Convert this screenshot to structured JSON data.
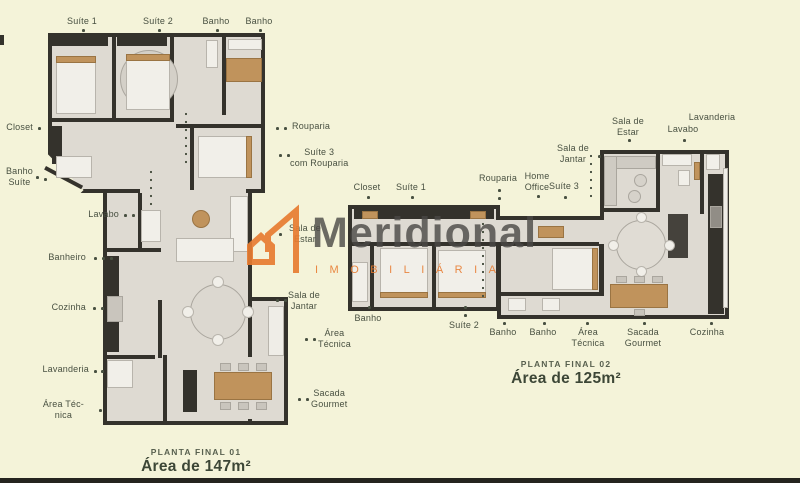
{
  "colors": {
    "bg": "#f4f3d9",
    "wall": "#34322c",
    "floor": "#dedad2",
    "wood": "#c0935c",
    "white": "#f1efe9",
    "gray": "#c9c5bd",
    "label": "#485041",
    "caption": "#3c4636",
    "accent": "#e87c31",
    "brand": "#4a4845"
  },
  "watermark": {
    "brand": "Meridional",
    "tagline": "IMOBILIÁRIA",
    "logo": "meridional-m-logo"
  },
  "plans": [
    {
      "id": "planta-final-01",
      "caption_title": "PLANTA FINAL 01",
      "caption_area": "Área de 147m²",
      "caption_x": 196,
      "caption_y": 447,
      "labels": [
        {
          "t": "Suíte 1",
          "x": 82,
          "y": 16,
          "a": "c"
        },
        {
          "t": "Suíte 2",
          "x": 158,
          "y": 16,
          "a": "c"
        },
        {
          "t": "Banho",
          "x": 216,
          "y": 16,
          "a": "c"
        },
        {
          "t": "Banho",
          "x": 259,
          "y": 16,
          "a": "c"
        },
        {
          "t": "Closet",
          "x": 33,
          "y": 122,
          "a": "r"
        },
        {
          "t": "Banho\nSuíte",
          "x": 33,
          "y": 166,
          "a": "r"
        },
        {
          "t": "Lavabo",
          "x": 119,
          "y": 209,
          "a": "r"
        },
        {
          "t": "Banheiro",
          "x": 86,
          "y": 252,
          "a": "r"
        },
        {
          "t": "Cozinha",
          "x": 86,
          "y": 302,
          "a": "r"
        },
        {
          "t": "Lavanderia",
          "x": 89,
          "y": 364,
          "a": "r"
        },
        {
          "t": "Área Téc-\nnica",
          "x": 84,
          "y": 399,
          "a": "r"
        },
        {
          "t": "Rouparia",
          "x": 292,
          "y": 121,
          "a": "l"
        },
        {
          "t": "Suíte 3\ncom Rouparia",
          "x": 290,
          "y": 147,
          "a": "l"
        },
        {
          "t": "Sala de\nEstar",
          "x": 289,
          "y": 223,
          "a": "l"
        },
        {
          "t": "Sala de\nJantar",
          "x": 288,
          "y": 290,
          "a": "l"
        },
        {
          "t": "Área\nTécnica",
          "x": 318,
          "y": 328,
          "a": "l"
        },
        {
          "t": "Sacada\nGourmet",
          "x": 311,
          "y": 388,
          "a": "l"
        }
      ],
      "dots": [
        [
          82,
          29
        ],
        [
          158,
          29
        ],
        [
          216,
          29
        ],
        [
          259,
          29
        ],
        [
          38,
          127
        ],
        [
          36,
          176
        ],
        [
          44,
          178
        ],
        [
          124,
          214
        ],
        [
          132,
          214
        ],
        [
          94,
          257
        ],
        [
          102,
          257
        ],
        [
          110,
          257
        ],
        [
          93,
          307
        ],
        [
          101,
          307
        ],
        [
          94,
          370
        ],
        [
          101,
          370
        ],
        [
          99,
          409
        ],
        [
          276,
          127
        ],
        [
          284,
          127
        ],
        [
          279,
          154
        ],
        [
          287,
          154
        ],
        [
          279,
          233
        ],
        [
          276,
          299
        ],
        [
          284,
          299
        ],
        [
          305,
          338
        ],
        [
          313,
          338
        ],
        [
          298,
          398
        ],
        [
          306,
          398
        ]
      ],
      "chains": [
        {
          "x": 185,
          "y": 110,
          "h": 54
        },
        {
          "x": 150,
          "y": 168,
          "h": 40
        }
      ]
    },
    {
      "id": "planta-final-02",
      "caption_title": "PLANTA FINAL 02",
      "caption_area": "Área de 125m²",
      "caption_x": 566,
      "caption_y": 359,
      "labels": [
        {
          "t": "Closet",
          "x": 367,
          "y": 182,
          "a": "c"
        },
        {
          "t": "Suíte 1",
          "x": 411,
          "y": 182,
          "a": "c"
        },
        {
          "t": "Rouparia",
          "x": 498,
          "y": 173,
          "a": "c"
        },
        {
          "t": "Home\nOffice",
          "x": 537,
          "y": 171,
          "a": "c"
        },
        {
          "t": "Suíte 3",
          "x": 564,
          "y": 181,
          "a": "c"
        },
        {
          "t": "Sala de\nJantar",
          "x": 573,
          "y": 143,
          "a": "c"
        },
        {
          "t": "Sala de\nEstar",
          "x": 628,
          "y": 116,
          "a": "c"
        },
        {
          "t": "Lavabo",
          "x": 683,
          "y": 124,
          "a": "c"
        },
        {
          "t": "Lavanderia",
          "x": 712,
          "y": 112,
          "a": "c"
        },
        {
          "t": "Banho",
          "x": 368,
          "y": 313,
          "a": "c"
        },
        {
          "t": "Suíte 2",
          "x": 464,
          "y": 320,
          "a": "c"
        },
        {
          "t": "Banho",
          "x": 503,
          "y": 327,
          "a": "c"
        },
        {
          "t": "Banho",
          "x": 543,
          "y": 327,
          "a": "c"
        },
        {
          "t": "Área\nTécnica",
          "x": 588,
          "y": 327,
          "a": "c"
        },
        {
          "t": "Sacada\nGourmet",
          "x": 643,
          "y": 327,
          "a": "c"
        },
        {
          "t": "Cozinha",
          "x": 707,
          "y": 327,
          "a": "c"
        }
      ],
      "dots": [
        [
          367,
          196
        ],
        [
          411,
          196
        ],
        [
          498,
          189
        ],
        [
          498,
          197
        ],
        [
          537,
          195
        ],
        [
          564,
          196
        ],
        [
          598,
          155
        ],
        [
          628,
          139
        ],
        [
          683,
          139
        ],
        [
          368,
          306
        ],
        [
          464,
          306
        ],
        [
          464,
          314
        ],
        [
          503,
          322
        ],
        [
          543,
          322
        ],
        [
          586,
          322
        ],
        [
          643,
          322
        ],
        [
          710,
          322
        ]
      ],
      "chains": [
        {
          "x": 590,
          "y": 152,
          "h": 50
        },
        {
          "x": 482,
          "y": 220,
          "h": 78
        }
      ]
    }
  ]
}
